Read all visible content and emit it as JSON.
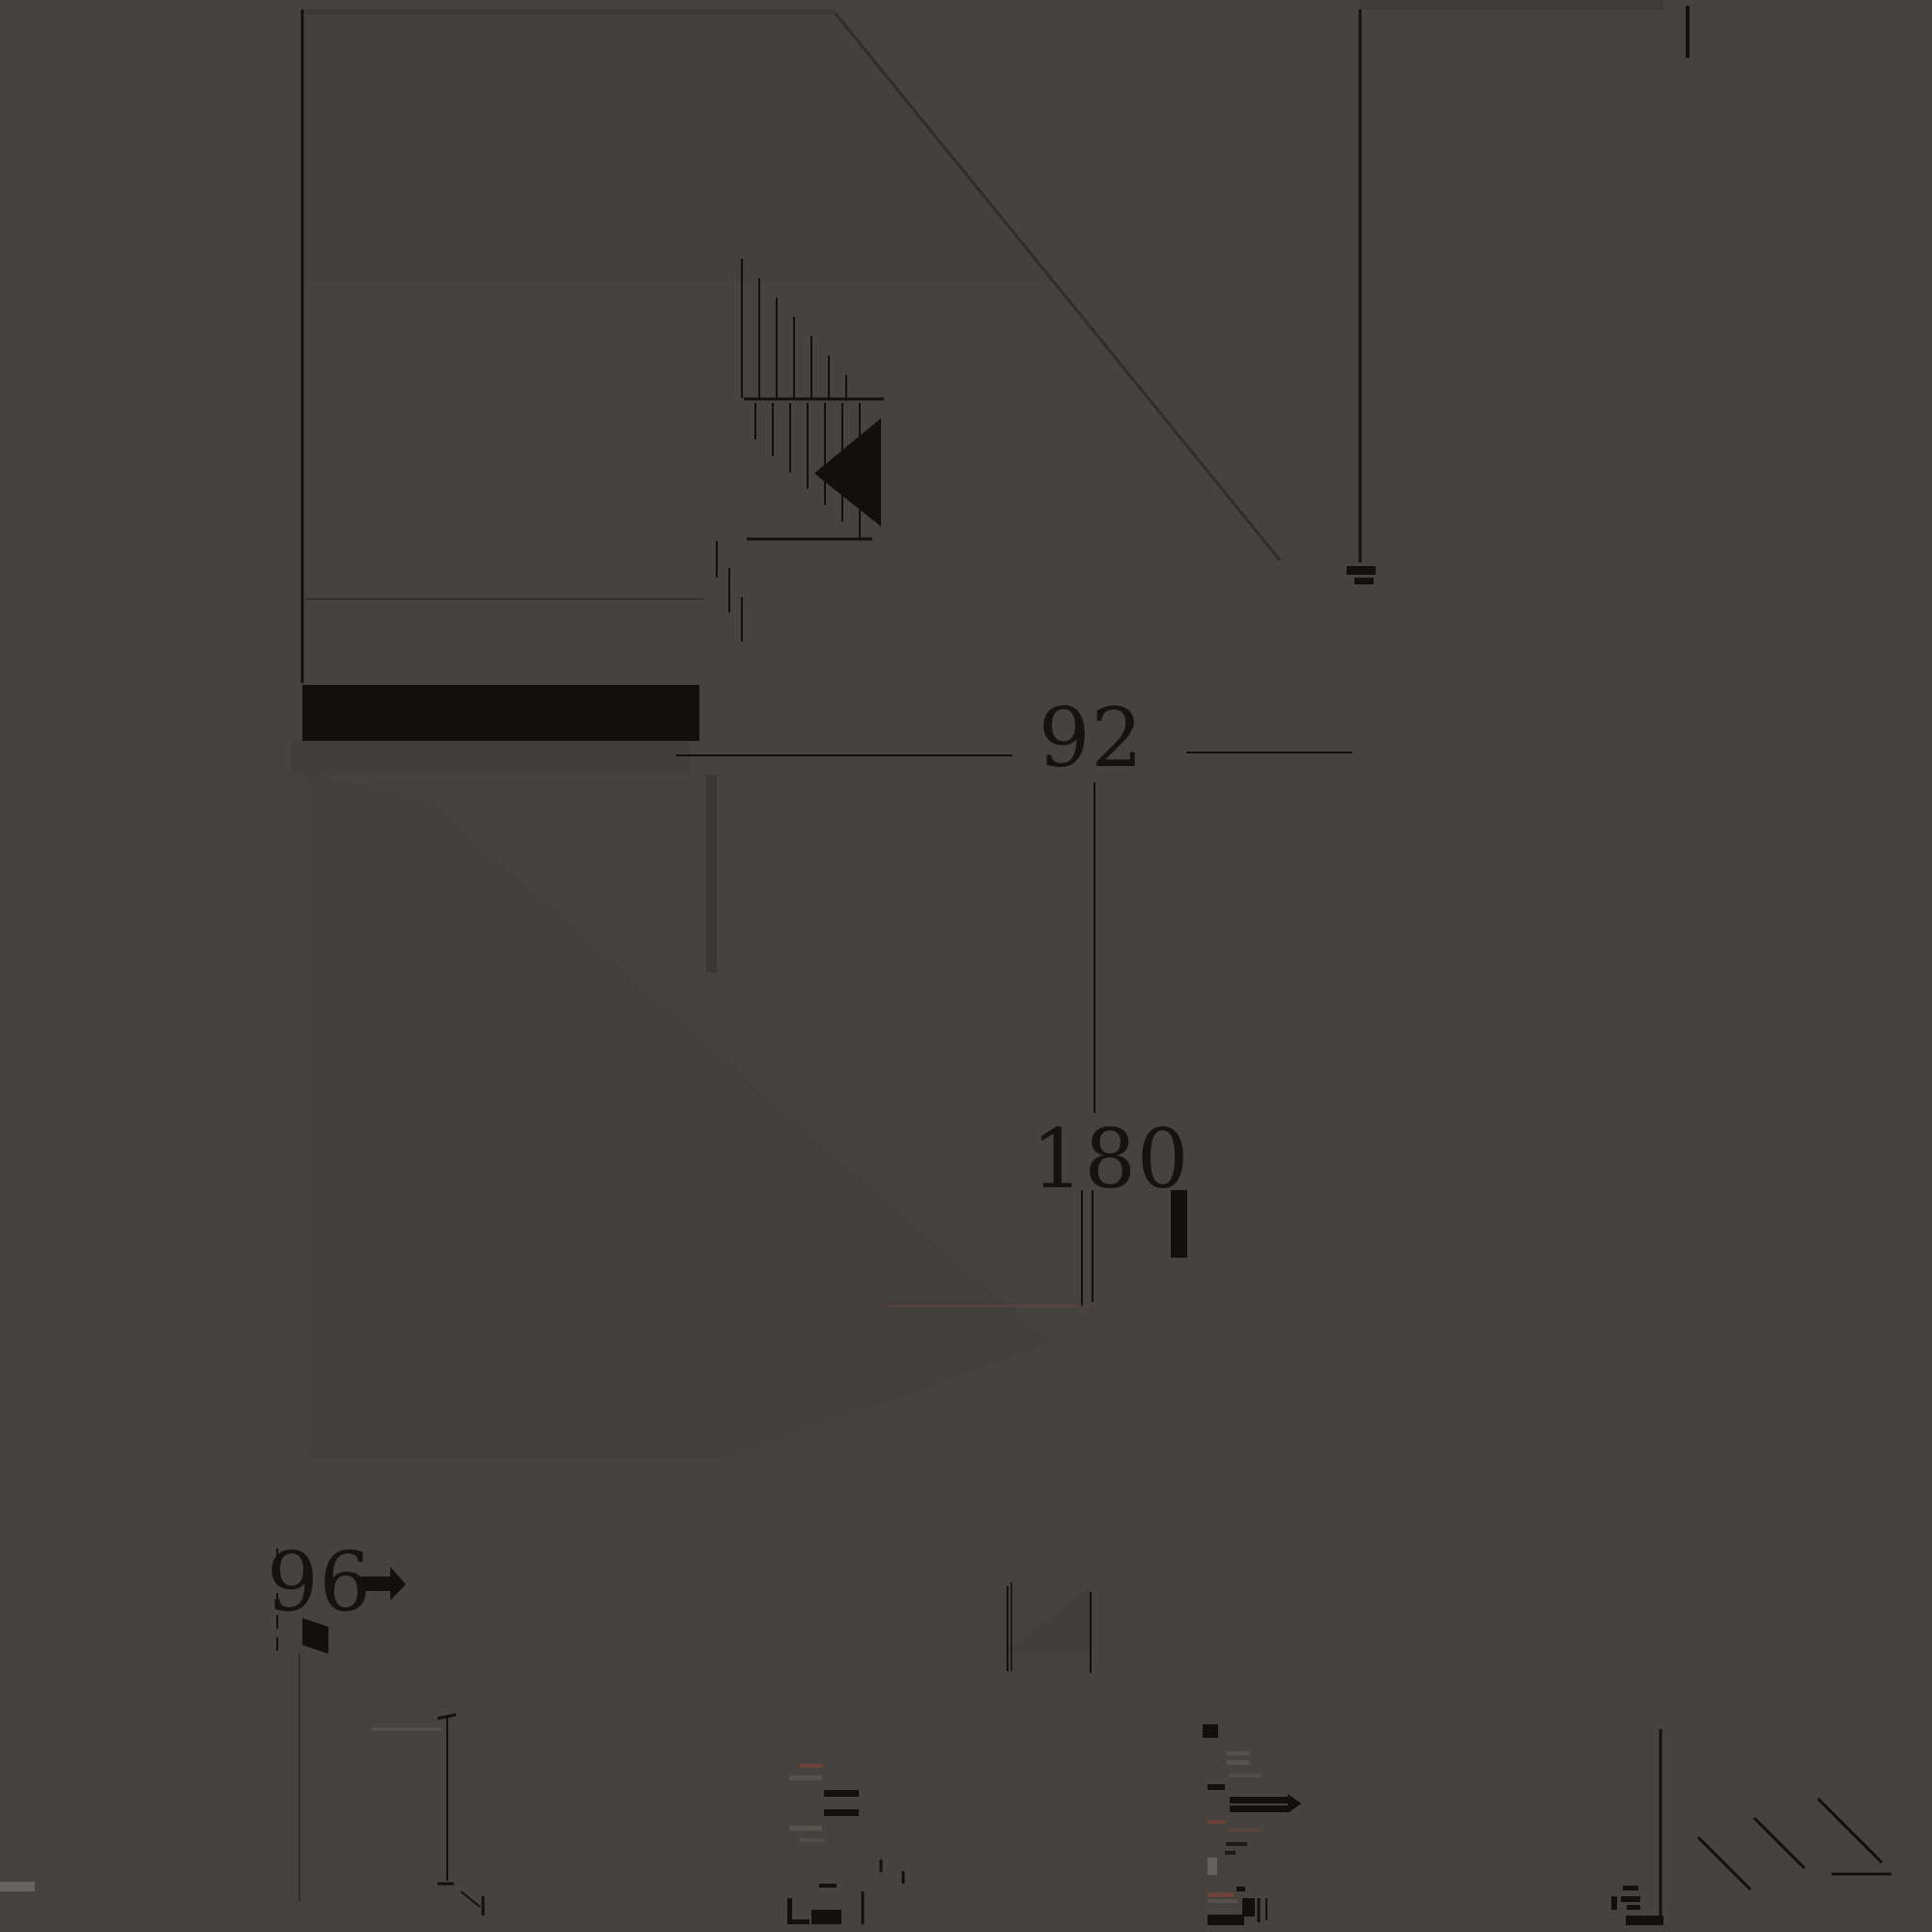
{
  "title": "Furniture dimension diagram",
  "colors": {
    "background": "#454240",
    "ink": "#12100d",
    "faint": "#2f2c28",
    "red": "#6b4338",
    "gray": "#56534f",
    "light": "#7e7b76"
  },
  "dimensions": {
    "d92": {
      "value": "92"
    },
    "d180": {
      "value": "180"
    },
    "d96": {
      "value": "96"
    }
  },
  "geometry": {
    "lines": [
      [
        313,
        10,
        313,
        707,
        "ink",
        3
      ],
      [
        1408,
        10,
        1408,
        582,
        "ink",
        3
      ],
      [
        865,
        14,
        1325,
        580,
        "faint",
        3,
        0.9
      ],
      [
        316,
        620,
        728,
        620,
        "faint",
        2,
        0.8
      ],
      [
        770,
        413,
        915,
        413,
        "ink",
        3
      ],
      [
        773,
        558,
        903,
        558,
        "ink",
        3
      ],
      [
        768,
        268,
        768,
        412,
        "ink",
        2
      ],
      [
        786,
        288,
        786,
        412,
        "ink",
        2
      ],
      [
        804,
        308,
        804,
        413,
        "ink",
        2
      ],
      [
        822,
        328,
        822,
        413,
        "ink",
        2
      ],
      [
        840,
        348,
        840,
        414,
        "ink",
        2
      ],
      [
        858,
        368,
        858,
        414,
        "ink",
        2
      ],
      [
        876,
        388,
        876,
        415,
        "ink",
        2
      ],
      [
        782,
        417,
        782,
        455,
        "ink",
        2
      ],
      [
        800,
        417,
        800,
        472,
        "ink",
        2
      ],
      [
        818,
        417,
        818,
        489,
        "ink",
        2
      ],
      [
        836,
        417,
        836,
        506,
        "ink",
        2
      ],
      [
        854,
        417,
        854,
        523,
        "ink",
        2
      ],
      [
        872,
        417,
        872,
        540,
        "ink",
        2
      ],
      [
        890,
        417,
        890,
        557,
        "ink",
        2
      ],
      [
        742,
        560,
        742,
        598,
        "ink",
        2
      ],
      [
        755,
        588,
        755,
        634,
        "ink",
        2
      ],
      [
        768,
        618,
        768,
        664,
        "ink",
        2
      ],
      [
        700,
        782,
        1048,
        782,
        "ink",
        2
      ],
      [
        1228,
        779,
        1400,
        779,
        "ink",
        2
      ],
      [
        1133,
        810,
        1133,
        1152,
        "ink",
        2
      ],
      [
        1120,
        1232,
        1120,
        1353,
        "ink",
        2
      ],
      [
        1131,
        1232,
        1131,
        1348,
        "ink",
        2
      ],
      [
        1129,
        1648,
        1129,
        1732,
        "ink",
        2
      ],
      [
        287,
        1603,
        287,
        1712,
        "ink",
        2,
        1,
        "14 9"
      ],
      [
        310,
        1712,
        310,
        1968,
        "faint",
        2,
        0.9
      ],
      [
        463,
        1778,
        463,
        1947,
        "ink",
        2
      ],
      [
        385,
        1790,
        457,
        1790,
        "gray",
        3
      ],
      [
        453,
        1779,
        472,
        1775,
        "ink",
        3
      ],
      [
        453,
        1950,
        470,
        1950,
        "ink",
        3
      ],
      [
        477,
        1958,
        497,
        1974,
        "ink",
        2
      ],
      [
        893,
        1958,
        893,
        1992,
        "ink",
        3
      ],
      [
        912,
        1925,
        912,
        1938,
        "ink",
        3
      ],
      [
        935,
        1937,
        935,
        1950,
        "ink",
        3
      ],
      [
        500,
        1963,
        500,
        1983,
        "ink",
        3
      ],
      [
        1303,
        1965,
        1303,
        1990,
        "ink",
        3
      ],
      [
        1311,
        1965,
        1311,
        1988,
        "ink",
        2
      ],
      [
        1719,
        1790,
        1719,
        1983,
        "ink",
        3
      ],
      [
        1758,
        1902,
        1812,
        1956,
        "ink",
        3
      ],
      [
        1816,
        1882,
        1868,
        1934,
        "ink",
        3
      ],
      [
        1882,
        1862,
        1948,
        1928,
        "ink",
        3
      ],
      [
        1896,
        1940,
        1958,
        1940,
        "ink",
        3
      ],
      [
        918,
        1352,
        1128,
        1352,
        "red",
        2,
        0.55
      ],
      [
        1043,
        1642,
        1043,
        1730,
        "ink",
        2
      ],
      [
        1047,
        1638,
        1047,
        1730,
        "ink",
        1.5
      ]
    ],
    "rects": [
      [
        313,
        709,
        411,
        58,
        "ink"
      ],
      [
        316,
        9,
        549,
        6,
        "ink",
        0.15
      ],
      [
        1408,
        0,
        314,
        10,
        "ink",
        0.15
      ],
      [
        301,
        767,
        413,
        35,
        "ink",
        0.07
      ],
      [
        731,
        802,
        11,
        205,
        "ink",
        0.2
      ],
      [
        1245,
        1785,
        16,
        14,
        "ink"
      ],
      [
        1273,
        1860,
        60,
        7,
        "ink"
      ],
      [
        1273,
        1869,
        60,
        7,
        "ink"
      ],
      [
        1250,
        1847,
        18,
        6,
        "ink"
      ],
      [
        1250,
        1884,
        18,
        4,
        "red"
      ],
      [
        1272,
        1893,
        34,
        3,
        "red",
        0.5
      ],
      [
        1270,
        1813,
        24,
        4,
        "gray"
      ],
      [
        1270,
        1822,
        24,
        5,
        "gray"
      ],
      [
        1272,
        1836,
        34,
        4,
        "gray",
        0.7
      ],
      [
        1269,
        1907,
        22,
        4,
        "ink",
        0.8
      ],
      [
        1268,
        1916,
        11,
        4,
        "ink",
        0.8
      ],
      [
        1250,
        1923,
        10,
        18,
        "light",
        0.55
      ],
      [
        1280,
        1953,
        9,
        5,
        "ink"
      ],
      [
        1250,
        1959,
        28,
        5,
        "red"
      ],
      [
        1250,
        1966,
        31,
        4,
        "gray"
      ],
      [
        1286,
        1965,
        13,
        19,
        "ink"
      ],
      [
        1250,
        1982,
        38,
        11,
        "ink"
      ],
      [
        828,
        1826,
        24,
        4,
        "red"
      ],
      [
        817,
        1838,
        34,
        5,
        "gray"
      ],
      [
        853,
        1853,
        36,
        7,
        "ink"
      ],
      [
        853,
        1873,
        36,
        7,
        "ink"
      ],
      [
        817,
        1890,
        34,
        5,
        "gray"
      ],
      [
        828,
        1903,
        26,
        4,
        "gray",
        0.7
      ],
      [
        848,
        1950,
        18,
        4,
        "ink"
      ],
      [
        840,
        1977,
        31,
        15,
        "ink"
      ],
      [
        815,
        1965,
        5,
        27,
        "ink"
      ],
      [
        815,
        1987,
        23,
        5,
        "ink"
      ],
      [
        1680,
        1952,
        16,
        5,
        "ink"
      ],
      [
        1668,
        1963,
        6,
        14,
        "ink"
      ],
      [
        1678,
        1963,
        20,
        6,
        "ink"
      ],
      [
        1684,
        1972,
        14,
        5,
        "ink"
      ],
      [
        1683,
        1983,
        39,
        10,
        "ink"
      ],
      [
        1745,
        6,
        4,
        54,
        "ink"
      ],
      [
        0,
        1948,
        36,
        10,
        "light",
        0.6
      ],
      [
        1394,
        586,
        30,
        9,
        "ink"
      ],
      [
        1402,
        598,
        20,
        7,
        "ink"
      ],
      [
        1212,
        1232,
        17,
        70,
        "ink"
      ]
    ],
    "polys": [
      [
        "912,433 912,545 843,490",
        "ink",
        1
      ],
      [
        "313,1675 340,1684 340,1712 313,1703",
        "ink",
        1
      ],
      [
        "373,1632 404,1632 404,1622 420,1640 404,1657 404,1647 373,1647",
        "ink",
        1
      ],
      [
        "316,800 440,828 1088,1390 745,1510 316,1510",
        "ink",
        0.05
      ],
      [
        "1040,1712 1129,1642 1129,1712",
        "ink",
        0.07
      ],
      [
        "1333,1857 1347,1867 1333,1877",
        "ink",
        1
      ],
      [
        "316,12 863,12 1087,292 316,292",
        "ink",
        0.04
      ]
    ]
  }
}
